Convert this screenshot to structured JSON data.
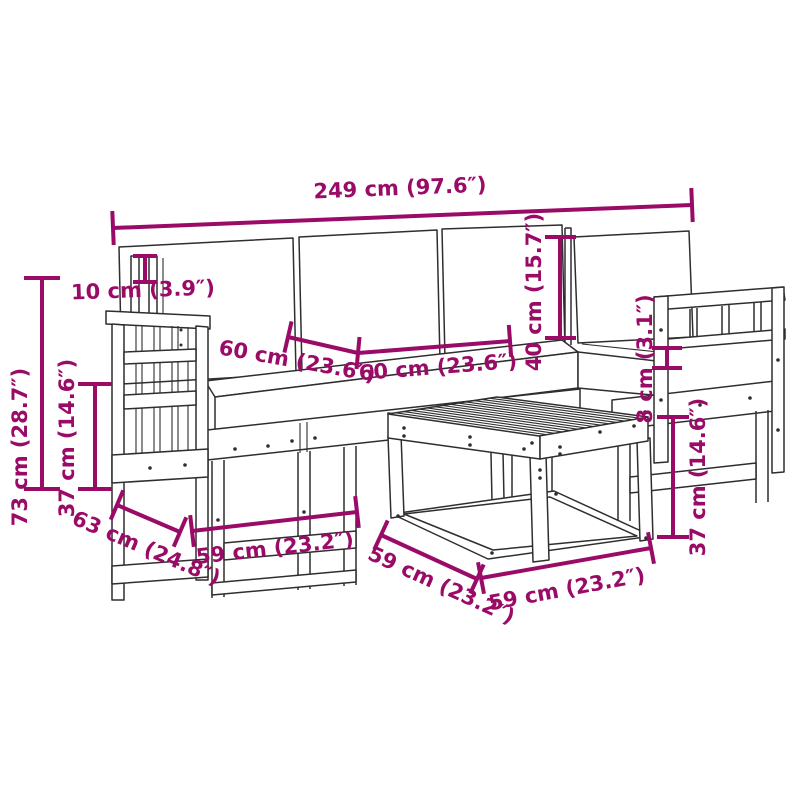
{
  "figure_type": "product-dimension-diagram",
  "subject": "garden-sofa-set-with-table-line-drawing",
  "colors": {
    "background": "#ffffff",
    "line_art": "#2e2e2e",
    "dimension_annotation": "#9a0b67"
  },
  "dimensions": {
    "overall_width": {
      "label": "249 cm (97.6″)",
      "cm": 249,
      "inches": 97.6
    },
    "backrest_post_height": {
      "label": "10 cm (3.9″)",
      "cm": 10,
      "inches": 3.9
    },
    "overall_height": {
      "label": "73 cm (28.7″)",
      "cm": 73,
      "inches": 28.7
    },
    "seat_frame_height_left": {
      "label": "37 cm (14.6″)",
      "cm": 37,
      "inches": 14.6
    },
    "back_cushion_height": {
      "label": "40 cm (15.7″)",
      "cm": 40,
      "inches": 15.7
    },
    "module_width_1": {
      "label": "60 cm (23.6″)",
      "cm": 60,
      "inches": 23.6
    },
    "module_width_2": {
      "label": "60 cm (23.6″)",
      "cm": 60,
      "inches": 23.6
    },
    "seat_cushion_thickness": {
      "label": "8 cm (3.1″)",
      "cm": 8,
      "inches": 3.1
    },
    "table_height": {
      "label": "37 cm (14.6″)",
      "cm": 37,
      "inches": 14.6
    },
    "module_depth": {
      "label": "63 cm (24.8″)",
      "cm": 63,
      "inches": 24.8
    },
    "module_front_width": {
      "label": "59 cm (23.2″)",
      "cm": 59,
      "inches": 23.2
    },
    "table_depth": {
      "label": "59 cm (23.2″)",
      "cm": 59,
      "inches": 23.2
    },
    "table_width": {
      "label": "59 cm (23.2″)",
      "cm": 59,
      "inches": 23.2
    }
  }
}
